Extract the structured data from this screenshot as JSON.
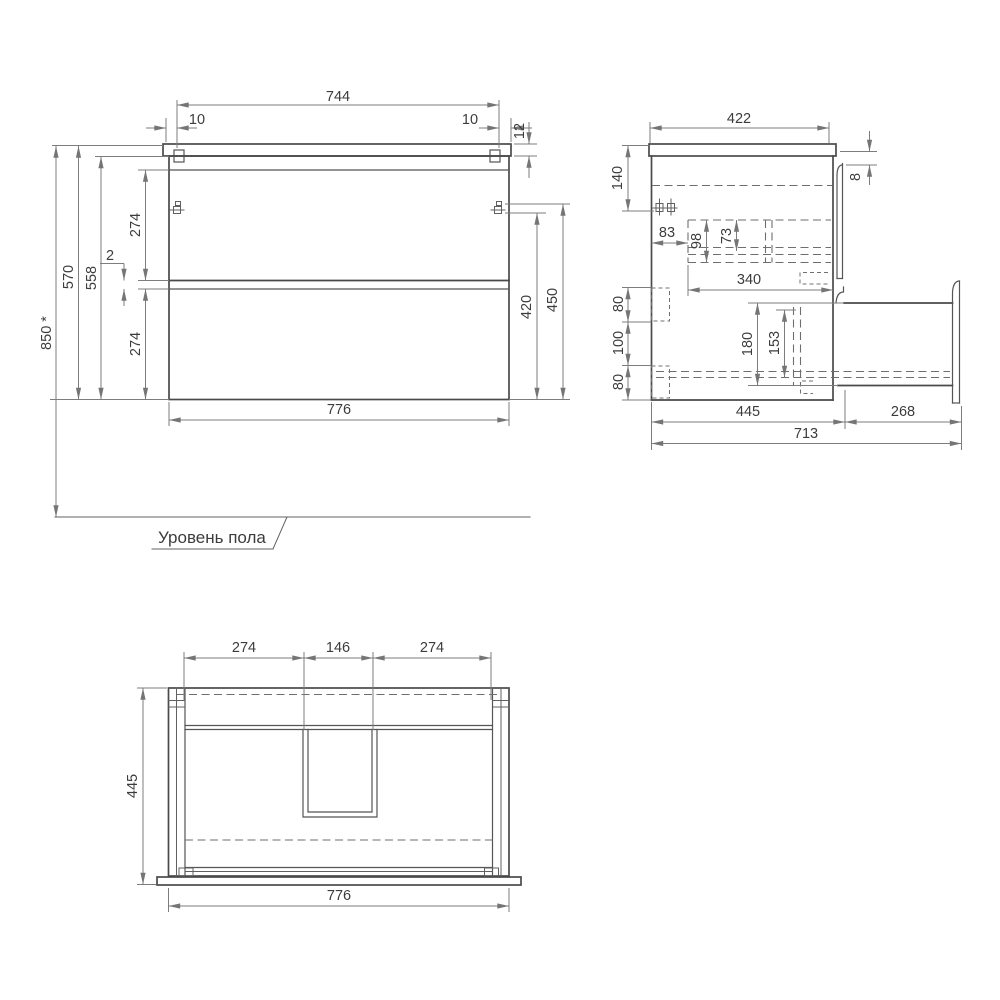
{
  "drawing": {
    "floor_label": "Уровень пола",
    "front": {
      "top_width": "744",
      "left_offset": "10",
      "right_offset": "10",
      "countertop_thickness": "12",
      "total_height": "850 *",
      "height_with_top": "570",
      "body_height": "558",
      "upper_drawer_height": "274",
      "drawer_gap": "2",
      "lower_drawer_height": "274",
      "bottom_width": "776",
      "bracket_height_low": "420",
      "bracket_height_high": "450"
    },
    "side": {
      "top_depth": "422",
      "bracket_offset_top": "140",
      "top_gap": "8",
      "bracket_offset_back": "83",
      "upper_box_height": "98",
      "upper_box_inner_height": "73",
      "upper_box_depth": "340",
      "rear_spacing_top": "80",
      "rear_spacing_mid": "100",
      "rear_spacing_bottom": "80",
      "lower_box_height": "180",
      "lower_box_inner_height": "153",
      "body_depth": "445",
      "drawer_extension": "268",
      "total_depth": "713"
    },
    "bottom": {
      "section_left": "274",
      "cutout_width": "146",
      "section_right": "274",
      "depth": "445",
      "width": "776"
    }
  }
}
